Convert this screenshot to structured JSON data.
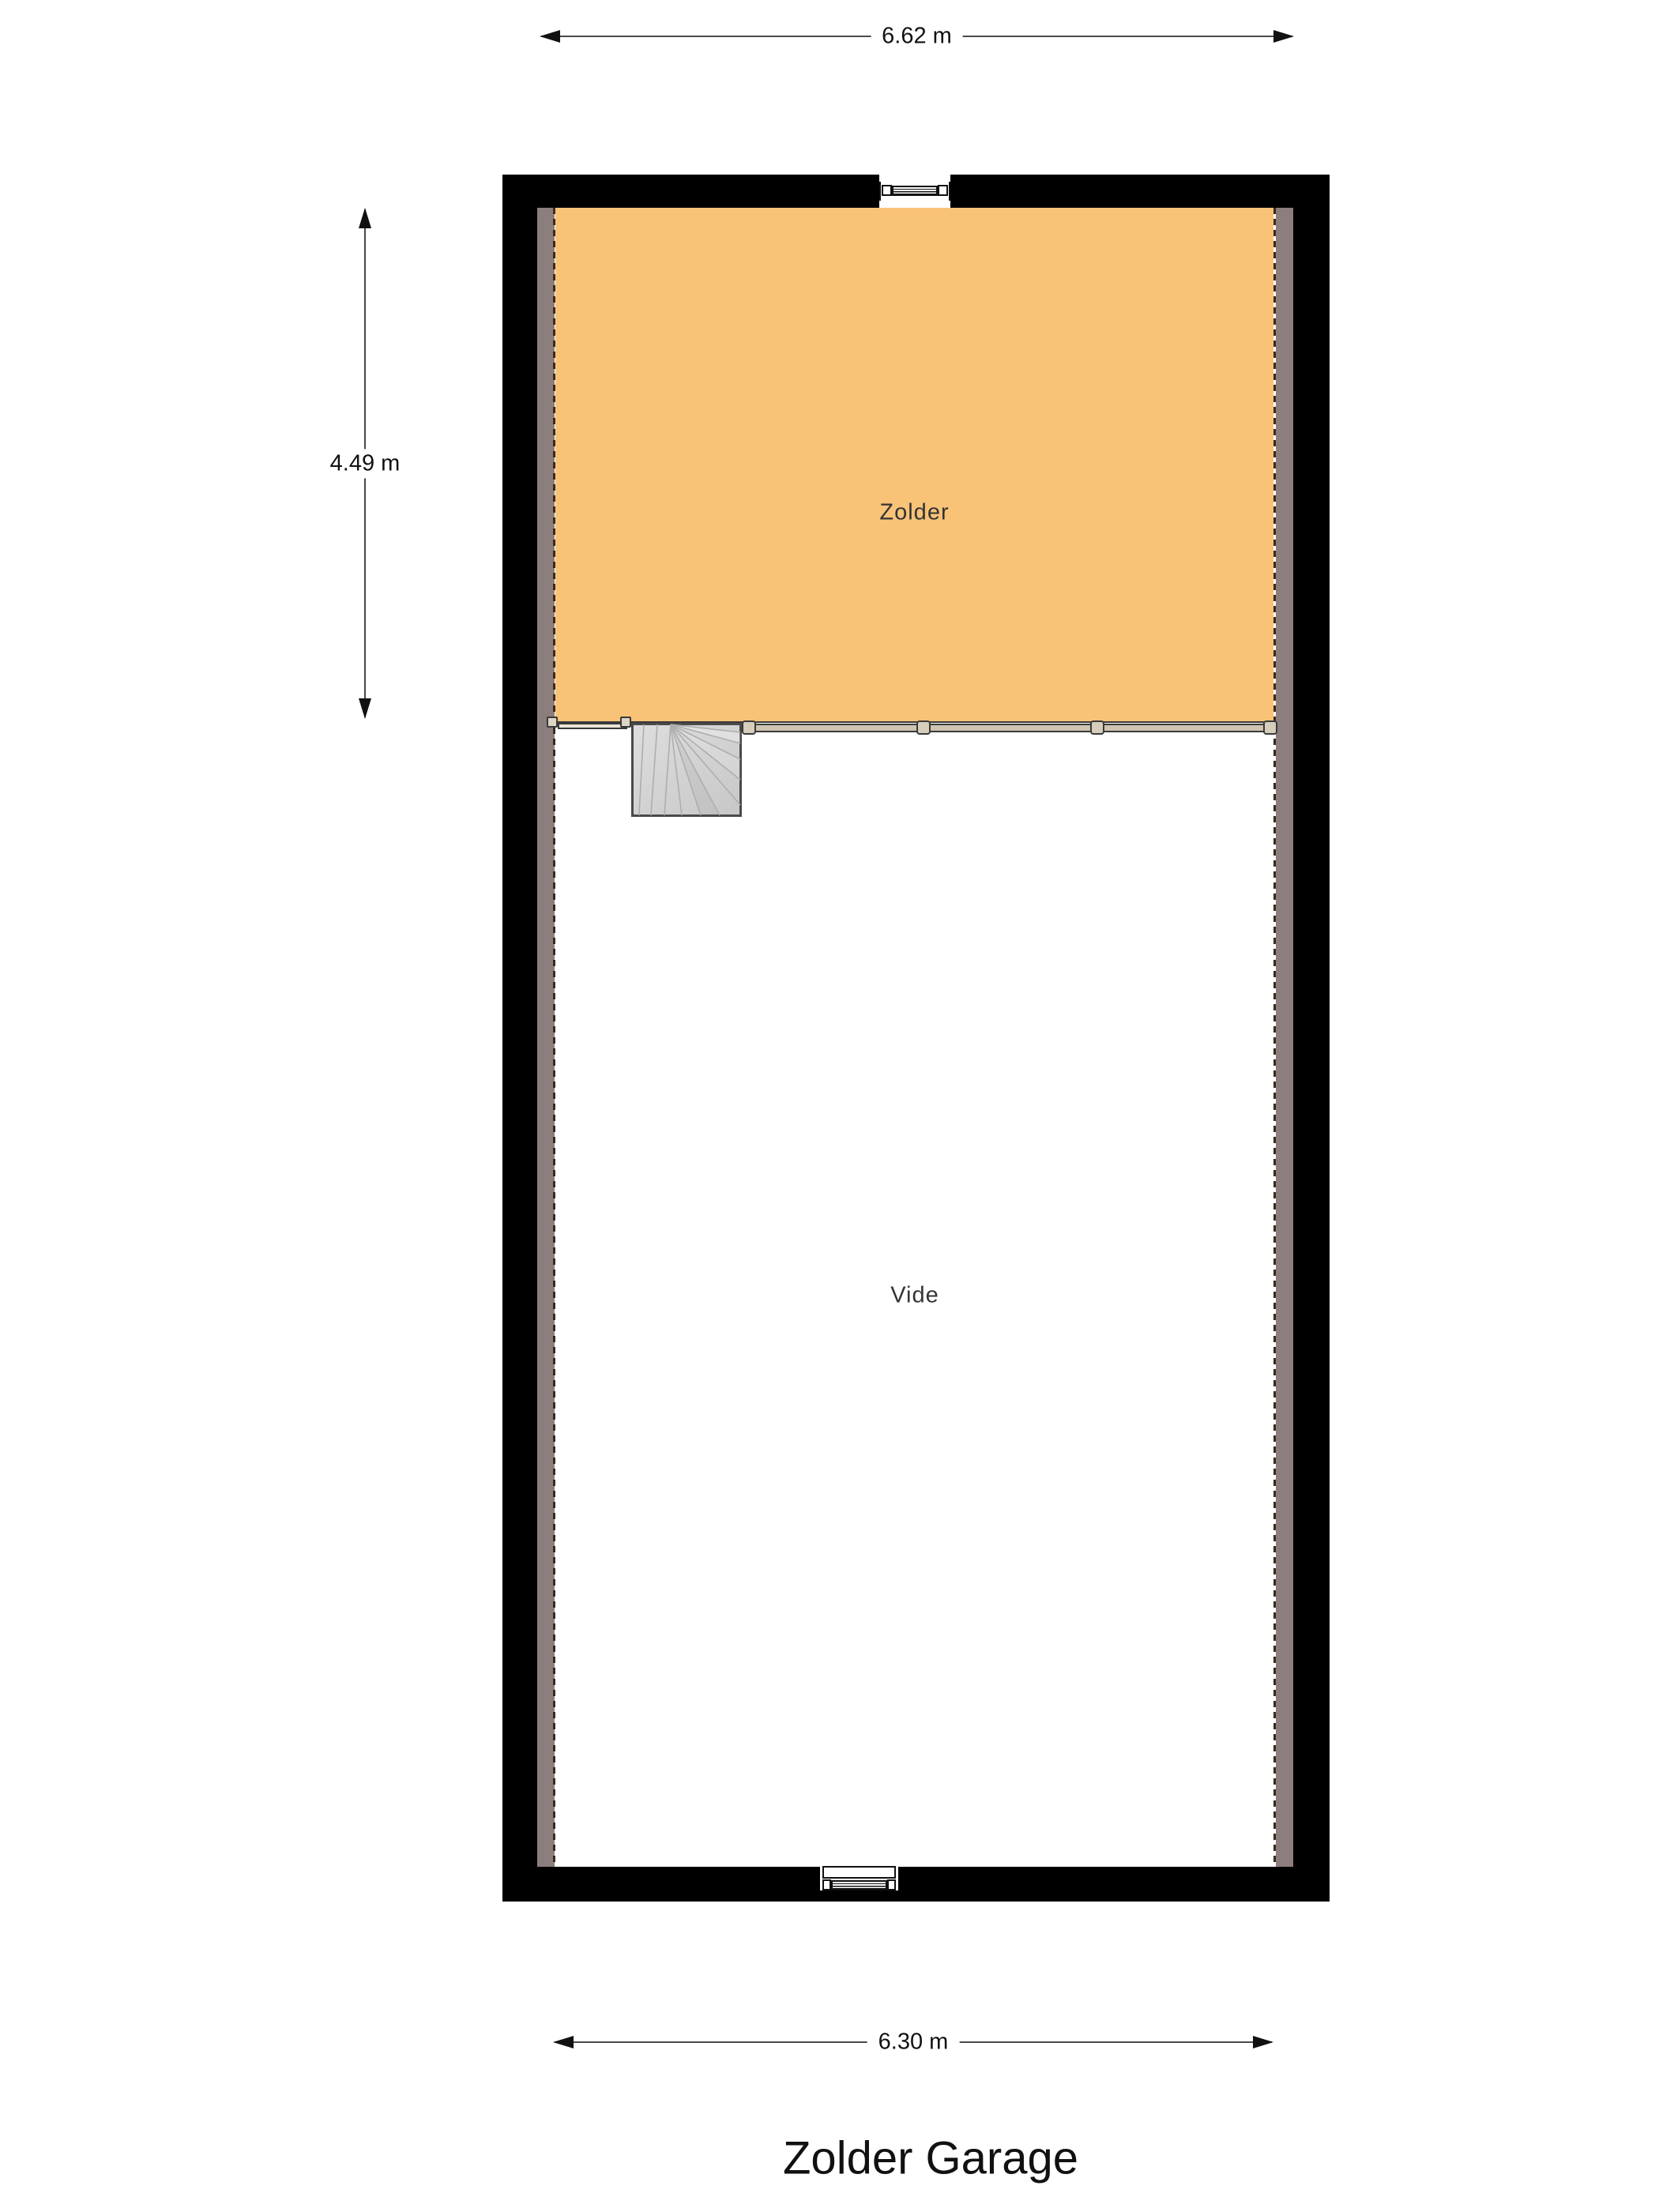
{
  "title": {
    "text": "Zolder Garage"
  },
  "dimensions": {
    "top_width": "6.62 m",
    "room_height": "4.49 m",
    "bottom_width": "6.30 m"
  },
  "rooms": {
    "zolder": {
      "label": "Zolder",
      "fill": "#F8C377"
    },
    "vide": {
      "label": "Vide",
      "fill": "#FFFFFF"
    }
  },
  "colors": {
    "wall": "#000000",
    "inner_wall_strip": "#8B7E7C",
    "dashed_edge": "#3A2B1B",
    "room_border": "#3A3A3A",
    "railing_bar": "#CDC4B2",
    "railing_post": "#D6CDBB",
    "stairs_fill_light": "#DEDEDE",
    "stairs_fill_dark": "#C7C7C7",
    "stairs_border": "#4A4A4A",
    "dimension_line": "#4A4A4A",
    "dimension_text": "#111111",
    "label_text": "#333333"
  },
  "icons": {
    "stairs": "stairs-icon",
    "window_top": "window-icon",
    "window_bottom": "window-icon",
    "arrows": [
      "arrow-left-icon",
      "arrow-right-icon",
      "arrow-up-icon",
      "arrow-down-icon"
    ]
  }
}
